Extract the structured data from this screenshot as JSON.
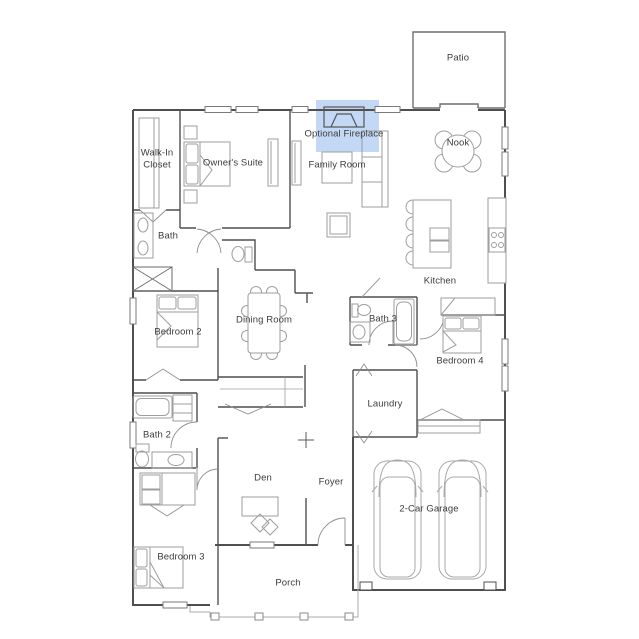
{
  "plan": {
    "title": "Single-story home floor plan",
    "highlight_color": "#b9d1f2",
    "rooms": [
      {
        "id": "patio",
        "label": "Patio"
      },
      {
        "id": "optional-fireplace",
        "label": "Optional Fireplace"
      },
      {
        "id": "walk-in-closet",
        "label": "Walk-In Closet"
      },
      {
        "id": "owners-suite",
        "label": "Owner's Suite"
      },
      {
        "id": "family-room",
        "label": "Family Room"
      },
      {
        "id": "nook",
        "label": "Nook"
      },
      {
        "id": "bath",
        "label": "Bath"
      },
      {
        "id": "kitchen",
        "label": "Kitchen"
      },
      {
        "id": "bedroom-2",
        "label": "Bedroom 2"
      },
      {
        "id": "dining-room",
        "label": "Dining Room"
      },
      {
        "id": "bath-3",
        "label": "Bath 3"
      },
      {
        "id": "bedroom-4",
        "label": "Bedroom 4"
      },
      {
        "id": "laundry",
        "label": "Laundry"
      },
      {
        "id": "bath-2",
        "label": "Bath 2"
      },
      {
        "id": "bedroom-3",
        "label": "Bedroom 3"
      },
      {
        "id": "den",
        "label": "Den"
      },
      {
        "id": "foyer",
        "label": "Foyer"
      },
      {
        "id": "garage",
        "label": "2-Car Garage"
      },
      {
        "id": "porch",
        "label": "Porch"
      }
    ]
  }
}
